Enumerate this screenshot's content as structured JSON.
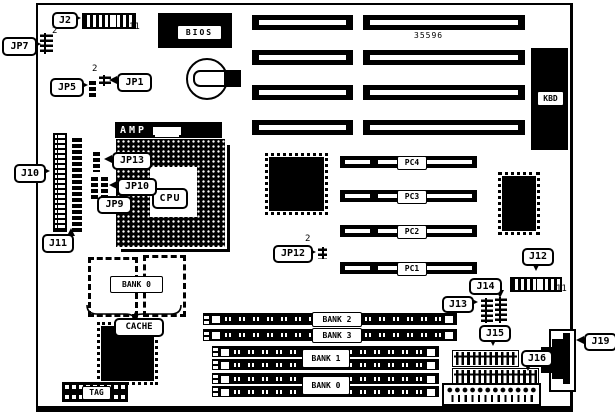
{
  "diagram": {
    "part_number": "35596",
    "callouts": {
      "j2": "J2",
      "jp7": "JP7",
      "jp5": "JP5",
      "jp1": "JP1",
      "j10": "J10",
      "j11": "J11",
      "jp13": "JP13",
      "jp10": "JP10",
      "jp9": "JP9",
      "jp12": "JP12",
      "j12": "J12",
      "j13": "J13",
      "j14": "J14",
      "j15": "J15",
      "j16": "J16",
      "j19": "J19"
    },
    "components": {
      "bios": "BIOS",
      "kbd": "KBD",
      "amp": "AMP",
      "cpu": "CPU",
      "cache": "CACHE",
      "tag": "TAG",
      "cache_bank": "BANK 0"
    },
    "pc_slots": [
      "PC4",
      "PC3",
      "PC2",
      "PC1"
    ],
    "memory_banks": {
      "bank2": "BANK 2",
      "bank3": "BANK 3",
      "bank1": "BANK 1",
      "bank0": "BANK 0"
    },
    "pin_numbers": {
      "j2": "11",
      "j12": "11",
      "jp7": "2",
      "jp1": "2",
      "jp12": "2"
    },
    "colors": {
      "ink": "#000000",
      "paper": "#ffffff"
    }
  }
}
